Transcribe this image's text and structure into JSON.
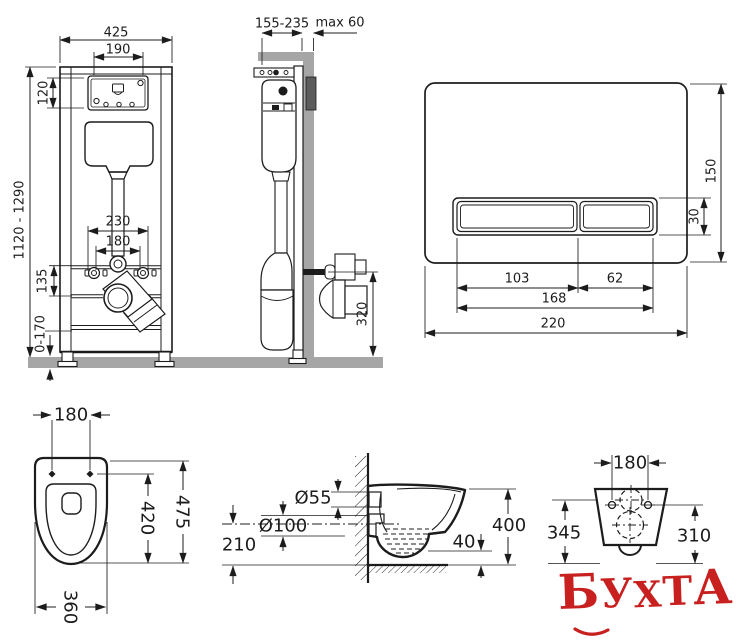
{
  "diagram": {
    "frame_front": {
      "overall_width": "425",
      "service_window_width": "190",
      "service_window_height": "120",
      "frame_height_range": "1120 - 1290",
      "fixing_spacing_outer": "230",
      "fixing_spacing_inner": "180",
      "rail_offset": "135",
      "leg_adjustment": "0-170"
    },
    "frame_side": {
      "install_depth_range": "155-235",
      "max_finish_thickness": "max 60",
      "outlet_height": "320"
    },
    "flush_plate": {
      "plate_height": "150",
      "button_height": "30",
      "large_button_width": "103",
      "small_button_width": "62",
      "buttons_total_width": "168",
      "plate_width": "220"
    },
    "bowl_top": {
      "hole_spacing": "180",
      "bowl_length": "475",
      "seat_length": "420",
      "bowl_width": "360"
    },
    "bowl_side": {
      "inlet_diameter": "Ø55",
      "outlet_diameter": "Ø100",
      "outlet_axis_height": "210",
      "bowl_height": "400",
      "rim_gap": "40"
    },
    "bowl_rear": {
      "hole_spacing": "180",
      "left_height": "345",
      "right_height": "310"
    }
  },
  "watermark": {
    "text": "БУХТА",
    "letters": [
      "Б",
      "У",
      "Х",
      "Т",
      "А"
    ],
    "color": "#c81f1f"
  },
  "colors": {
    "line": "#1c1c1c",
    "wall_fill": "#a6a6a6",
    "bracket_fill": "#5c5c5c",
    "background": "#ffffff"
  }
}
